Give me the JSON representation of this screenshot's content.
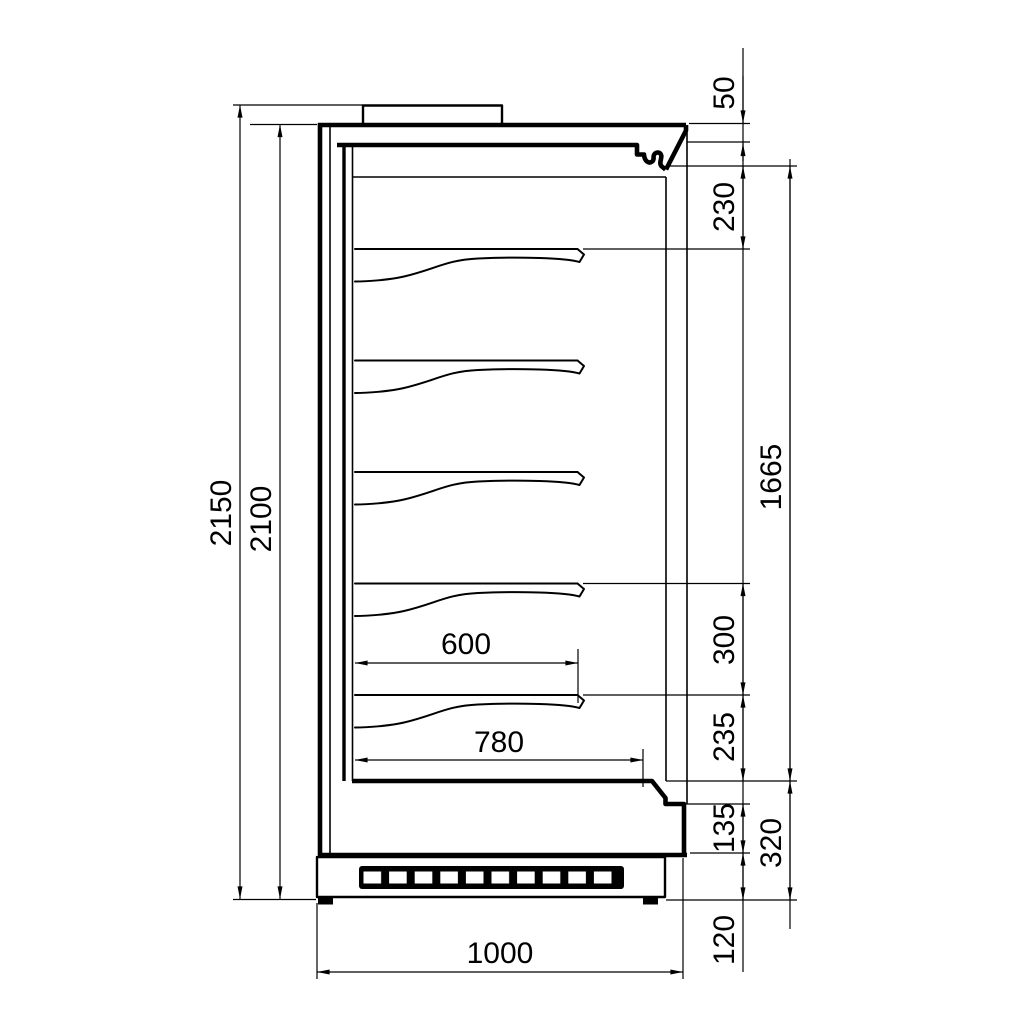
{
  "drawing": {
    "subject": "refrigerated multideck display cabinet side cross-section",
    "units": "mm",
    "line_color": "#000000",
    "background_color": "#ffffff",
    "shelf_count": 5,
    "dimensions": {
      "overall_height": "2150",
      "body_height": "2100",
      "top_panel_height": "50",
      "canopy_to_first_shelf": "230",
      "display_opening_height": "1665",
      "shelf_pitch": "300",
      "bottom_shelf_to_deck": "235",
      "front_lower_panel_height": "135",
      "base_section_height": "320",
      "plinth_height": "120",
      "shelf_depth": "600",
      "deck_depth": "780",
      "overall_depth": "1000"
    }
  }
}
